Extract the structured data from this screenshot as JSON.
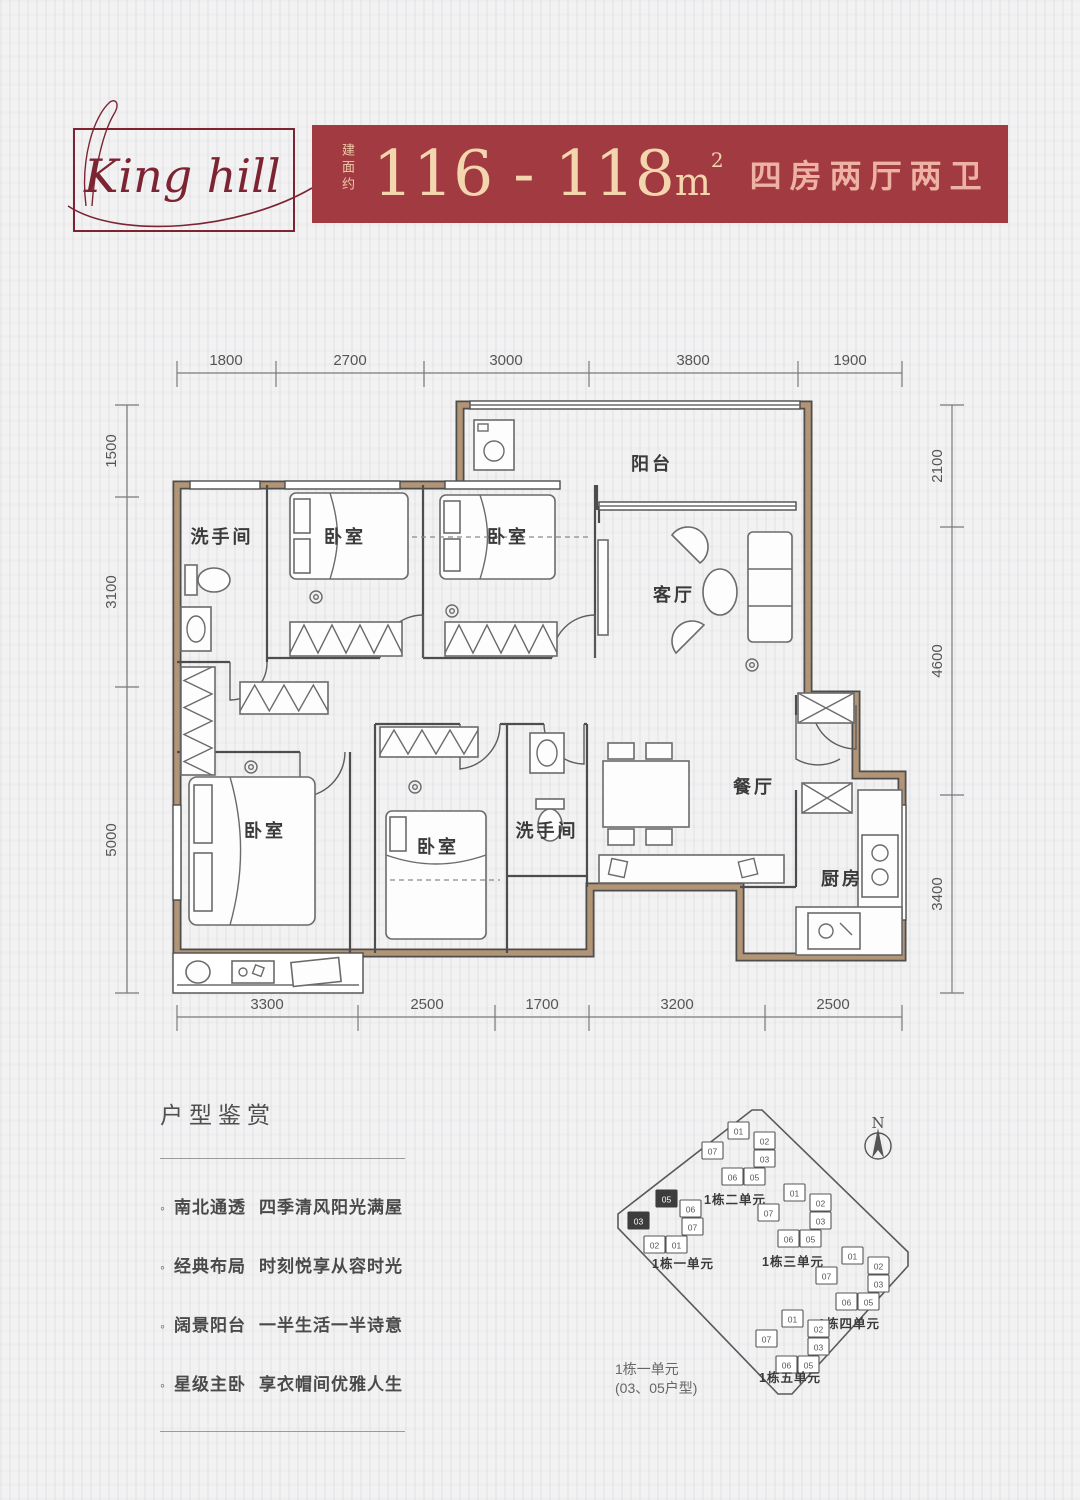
{
  "theme": {
    "banner-red": "#a23a42",
    "cream": "#f3d5ae",
    "pink": "#edb2a4",
    "logo-red": "#7d2433",
    "wall-tan": "#b29477",
    "line": "#4d4d4d",
    "text-dark": "#3a3a3a",
    "text-gray": "#555555",
    "page-bg": "#f2f2f3"
  },
  "header": {
    "logo_text": "King hill",
    "area_prefix": "建面约",
    "area_range": "116 - 118",
    "area_unit": "m",
    "area_sup": "2",
    "layout_desc": "四房两厅两卫"
  },
  "floorplan": {
    "rooms": [
      "洗手间",
      "卧室",
      "卧室",
      "阳台",
      "客厅",
      "卧室",
      "卧室",
      "洗手间",
      "餐厅",
      "厨房"
    ],
    "dims_top": [
      "1800",
      "2700",
      "3000",
      "3800",
      "1900"
    ],
    "dims_bottom": [
      "3300",
      "2500",
      "1700",
      "3200",
      "2500"
    ],
    "dims_left": [
      "1500",
      "3100",
      "5000"
    ],
    "dims_right": [
      "2100",
      "4600",
      "3400"
    ]
  },
  "features": {
    "title": "户型鉴赏",
    "items": [
      {
        "head": "南北通透",
        "tail": "四季清风阳光满屋"
      },
      {
        "head": "经典布局",
        "tail": "时刻悦享从容时光"
      },
      {
        "head": "阔景阳台",
        "tail": "一半生活一半诗意"
      },
      {
        "head": "星级主卧",
        "tail": "享衣帽间优雅人生"
      }
    ]
  },
  "siteplan": {
    "compass": "N",
    "caption_line1": "1栋一单元",
    "caption_line2": "(03、05户型)",
    "clusters": [
      {
        "label": "1栋一单元",
        "cx": 72,
        "cy": 148,
        "lx": 83,
        "ly": 188,
        "units": [
          {
            "id": "05",
            "dx": -16,
            "dy": -38,
            "dark": true
          },
          {
            "id": "06",
            "dx": 8,
            "dy": -28,
            "dark": false
          },
          {
            "id": "07",
            "dx": 10,
            "dy": -10,
            "dark": false
          },
          {
            "id": "03",
            "dx": -44,
            "dy": -16,
            "dark": true
          },
          {
            "id": "02",
            "dx": -28,
            "dy": 8,
            "dark": false
          },
          {
            "id": "01",
            "dx": -6,
            "dy": 8,
            "dark": false
          }
        ]
      },
      {
        "label": "1栋二单元",
        "cx": 140,
        "cy": 80,
        "lx": 135,
        "ly": 124,
        "units": [
          {
            "id": "01",
            "dx": -12,
            "dy": -38,
            "dark": false
          },
          {
            "id": "02",
            "dx": 14,
            "dy": -28,
            "dark": false
          },
          {
            "id": "03",
            "dx": 14,
            "dy": -10,
            "dark": false
          },
          {
            "id": "07",
            "dx": -38,
            "dy": -18,
            "dark": false
          },
          {
            "id": "06",
            "dx": -18,
            "dy": 8,
            "dark": false
          },
          {
            "id": "05",
            "dx": 4,
            "dy": 8,
            "dark": false
          }
        ]
      },
      {
        "label": "1栋三单元",
        "cx": 196,
        "cy": 142,
        "lx": 193,
        "ly": 186,
        "units": [
          {
            "id": "01",
            "dx": -12,
            "dy": -38,
            "dark": false
          },
          {
            "id": "02",
            "dx": 14,
            "dy": -28,
            "dark": false
          },
          {
            "id": "03",
            "dx": 14,
            "dy": -10,
            "dark": false
          },
          {
            "id": "07",
            "dx": -38,
            "dy": -18,
            "dark": false
          },
          {
            "id": "06",
            "dx": -18,
            "dy": 8,
            "dark": false
          },
          {
            "id": "05",
            "dx": 4,
            "dy": 8,
            "dark": false
          }
        ]
      },
      {
        "label": "1栋四单元",
        "cx": 254,
        "cy": 205,
        "lx": 249,
        "ly": 248,
        "units": [
          {
            "id": "01",
            "dx": -12,
            "dy": -38,
            "dark": false
          },
          {
            "id": "02",
            "dx": 14,
            "dy": -28,
            "dark": false
          },
          {
            "id": "03",
            "dx": 14,
            "dy": -10,
            "dark": false
          },
          {
            "id": "07",
            "dx": -38,
            "dy": -18,
            "dark": false
          },
          {
            "id": "06",
            "dx": -18,
            "dy": 8,
            "dark": false
          },
          {
            "id": "05",
            "dx": 4,
            "dy": 8,
            "dark": false
          }
        ]
      },
      {
        "label": "1栋五单元",
        "cx": 194,
        "cy": 268,
        "lx": 190,
        "ly": 302,
        "units": [
          {
            "id": "01",
            "dx": -12,
            "dy": -38,
            "dark": false
          },
          {
            "id": "02",
            "dx": 14,
            "dy": -28,
            "dark": false
          },
          {
            "id": "03",
            "dx": 14,
            "dy": -10,
            "dark": false
          },
          {
            "id": "07",
            "dx": -38,
            "dy": -18,
            "dark": false
          },
          {
            "id": "06",
            "dx": -18,
            "dy": 8,
            "dark": false
          },
          {
            "id": "05",
            "dx": 4,
            "dy": 8,
            "dark": false
          }
        ]
      }
    ]
  }
}
